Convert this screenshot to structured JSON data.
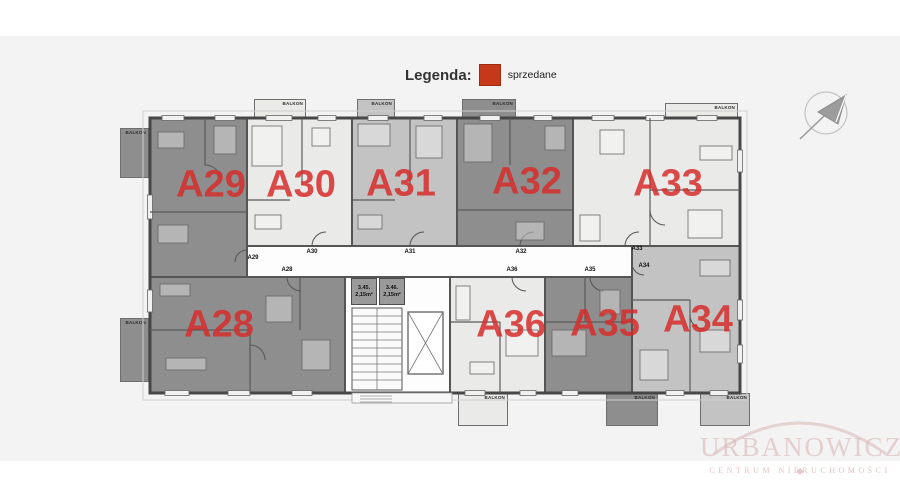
{
  "legend": {
    "title": "Legenda:",
    "items": [
      {
        "label": "sprzedane",
        "color": "#c5391a"
      }
    ]
  },
  "status_colors": {
    "sold": "#8e8e8e",
    "medium": "#c3c3c3",
    "light": "#eaeae8"
  },
  "label_color": "#d52d2a",
  "apartments": [
    {
      "id": "a29",
      "label": "A29",
      "status": "sold"
    },
    {
      "id": "a30",
      "label": "A30",
      "status": "light"
    },
    {
      "id": "a31",
      "label": "A31",
      "status": "medium"
    },
    {
      "id": "a32",
      "label": "A32",
      "status": "sold"
    },
    {
      "id": "a33",
      "label": "A33",
      "status": "light"
    },
    {
      "id": "a28",
      "label": "A28",
      "status": "sold"
    },
    {
      "id": "a36",
      "label": "A36",
      "status": "light"
    },
    {
      "id": "a35",
      "label": "A35",
      "status": "sold"
    },
    {
      "id": "a34",
      "label": "A34",
      "status": "medium"
    }
  ],
  "corridor_labels": [
    "A29",
    "A30",
    "A31",
    "A32",
    "A33",
    "A28",
    "A36",
    "A35",
    "A34"
  ],
  "storage_rooms": [
    {
      "id": "3.45.",
      "area": "2,15m²"
    },
    {
      "id": "3.46.",
      "area": "2,15m²"
    }
  ],
  "balconies": [
    {
      "id": "a29-left",
      "label": "BALKON",
      "status": "sold"
    },
    {
      "id": "a28-left",
      "label": "BALKON",
      "status": "sold"
    },
    {
      "id": "a30-top",
      "label": "BALKON",
      "status": "light"
    },
    {
      "id": "a31-top",
      "label": "BALKON",
      "status": "medium"
    },
    {
      "id": "a32-top",
      "label": "BALKON",
      "status": "sold"
    },
    {
      "id": "a33-top",
      "label": "BALKON",
      "status": "light"
    },
    {
      "id": "a36-bottom",
      "label": "BALKON",
      "status": "light"
    },
    {
      "id": "a35-bottom",
      "label": "BALKON",
      "status": "sold"
    },
    {
      "id": "a34-bottom",
      "label": "BALKON",
      "status": "medium"
    }
  ],
  "watermark": {
    "line1": "URBANOWICZ",
    "line2": "CENTRUM NIERUCHOMOŚCI"
  }
}
